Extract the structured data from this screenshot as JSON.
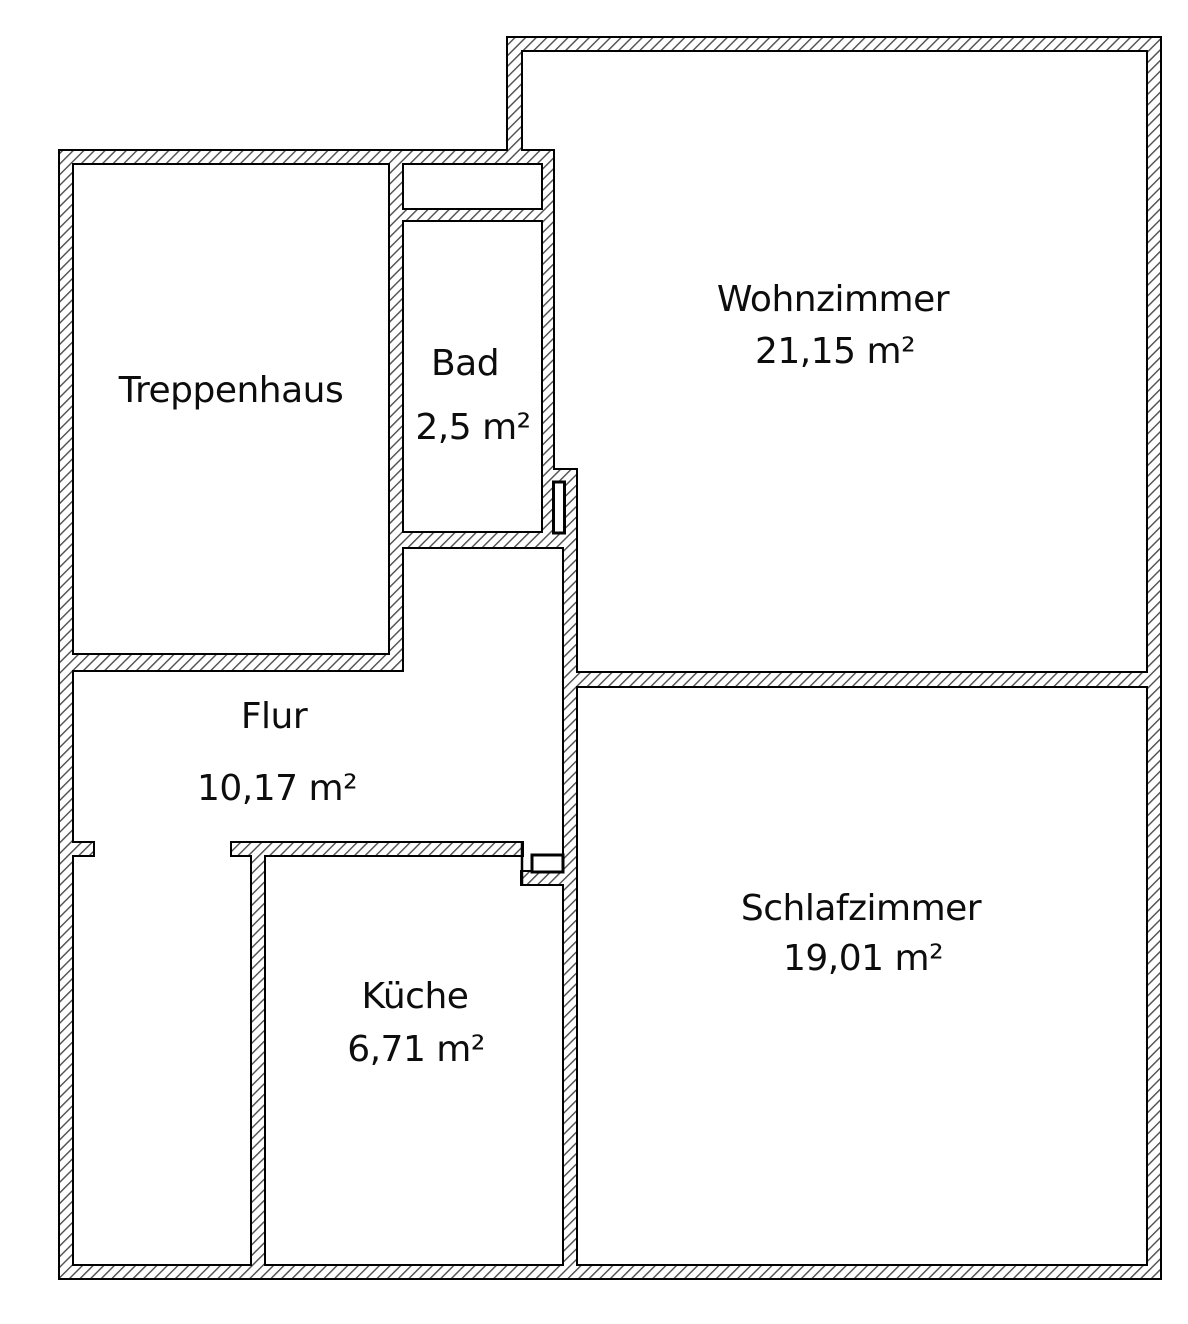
{
  "drawing": {
    "kind": "floorplan",
    "colors": {
      "background": "#ffffff",
      "wall_outline": "#000000",
      "wall_hatch": "#4d4d4d",
      "text": "#0d0d0d"
    },
    "rooms": [
      {
        "id": "treppenhaus",
        "name": "Treppenhaus",
        "area": ""
      },
      {
        "id": "bad",
        "name": "Bad",
        "area": "2,5 m²"
      },
      {
        "id": "wohnzimmer",
        "name": "Wohnzimmer",
        "area": "21,15 m²"
      },
      {
        "id": "flur",
        "name": "Flur",
        "area": "10,17 m²"
      },
      {
        "id": "kueche",
        "name": "Küche",
        "area": "6,71 m²"
      },
      {
        "id": "schlafzimmer",
        "name": "Schlafzimmer",
        "area": "19,01 m²"
      }
    ]
  }
}
